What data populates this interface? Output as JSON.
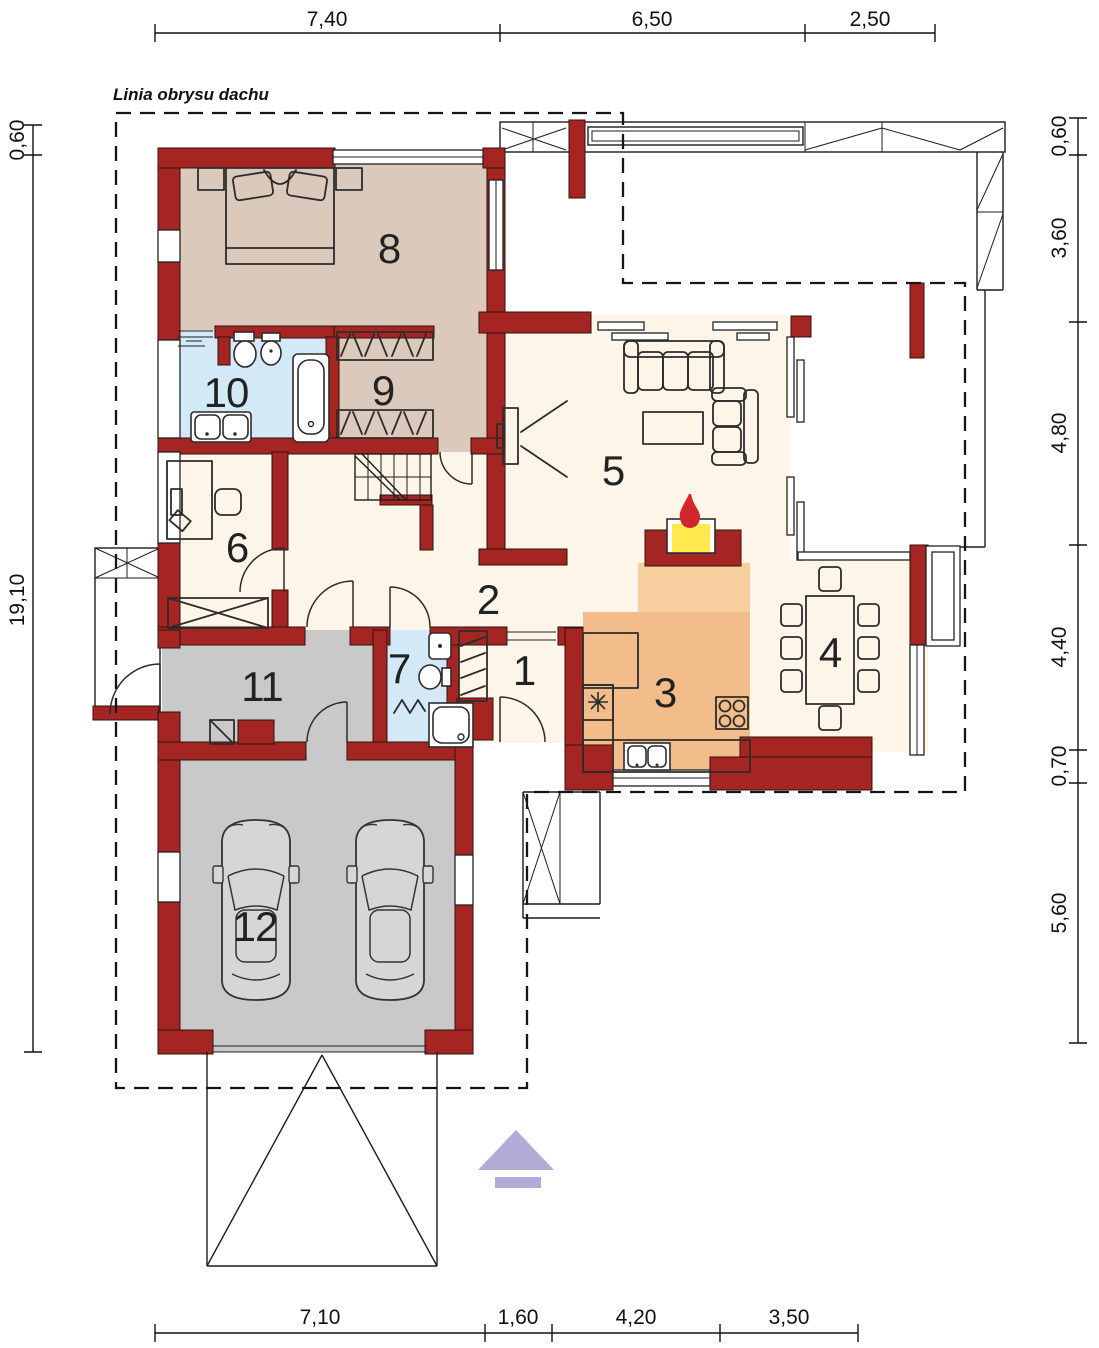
{
  "labels": {
    "roof_outline": "Linia obrysu dachu"
  },
  "dimensions": {
    "top": [
      "7,40",
      "6,50",
      "2,50"
    ],
    "bottom": [
      "7,10",
      "1,60",
      "4,20",
      "3,50"
    ],
    "left": [
      "0,60",
      "19,10"
    ],
    "right": [
      "0,60",
      "3,60",
      "4,80",
      "4,40",
      "0,70",
      "5,60"
    ]
  },
  "rooms": [
    {
      "number": "1"
    },
    {
      "number": "2"
    },
    {
      "number": "3"
    },
    {
      "number": "4"
    },
    {
      "number": "5"
    },
    {
      "number": "6"
    },
    {
      "number": "7"
    },
    {
      "number": "8"
    },
    {
      "number": "9"
    },
    {
      "number": "10"
    },
    {
      "number": "11"
    },
    {
      "number": "12"
    }
  ],
  "colors": {
    "wall": "#a42522",
    "bedroom": "#dbc9bc",
    "bath": "#d4e9f8",
    "floor": "#fdf6e8",
    "kitchen": "#f3bd8b",
    "hearth": "#f7cf9f",
    "garage": "#c9c9c9",
    "car": "#d6d6d6",
    "flameYellow": "#ffe94d",
    "flameRed": "#d1262b",
    "north": "#b2aad7",
    "ink": "#1d1d1d"
  }
}
